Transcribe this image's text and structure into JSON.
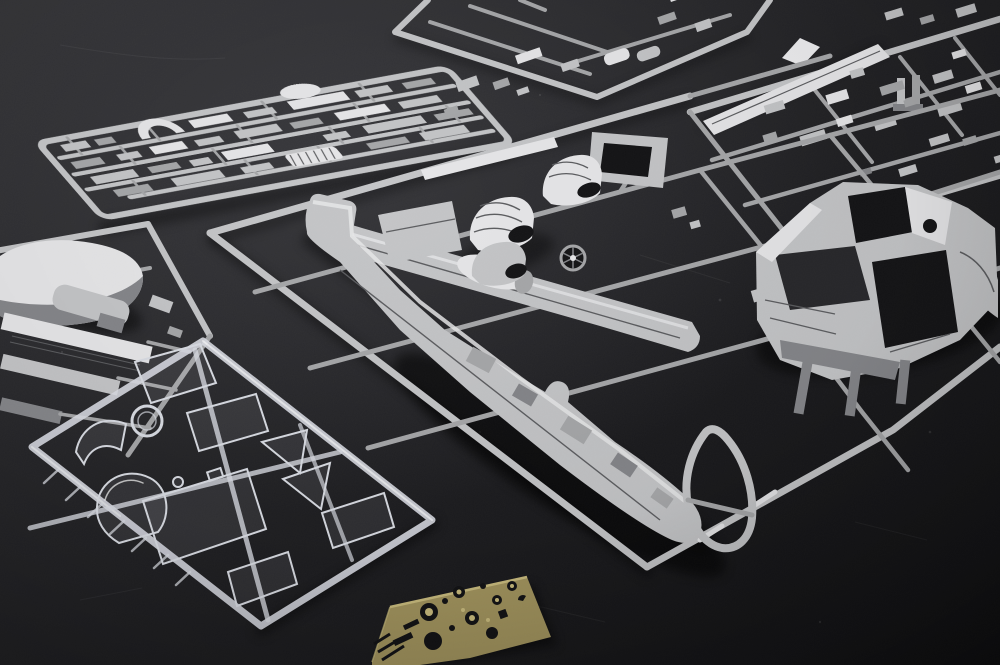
{
  "image": {
    "type": "photograph",
    "subject": "plastic scale-model aircraft kit contents laid out on a dark matte surface",
    "width_px": 1000,
    "height_px": 665
  },
  "colors": {
    "bg_top": "#323235",
    "bg_mid": "#202023",
    "bg_bottom": "#101012",
    "bg_patch": "#3a3a3e",
    "plastic_hi": "#e6e6e8",
    "plastic_light": "#c4c5c7",
    "plastic_mid": "#a6a7a9",
    "plastic_low": "#85868a",
    "plastic_deep": "#5c5d60",
    "opening_dark": "#141416",
    "opening_soft": "#28282b",
    "shadow_color": "#070708",
    "clear_stroke": "#d9dce3",
    "clear_hi": "#ffffff",
    "clear_fill": "rgba(205,210,220,0.10)",
    "brass_base": "#a3955e",
    "brass_hi": "#cbbd7e",
    "brass_hole": "#121214"
  },
  "objects": [
    {
      "id": "sprue-top-left",
      "kind": "gray styrene sprue",
      "contents": "rows of small detail parts, arch-shaped part, corrugated part"
    },
    {
      "id": "sprue-top-center",
      "kind": "gray styrene sprue (partially out of frame)",
      "contents": "small blocks and cylinder parts"
    },
    {
      "id": "sprue-top-right",
      "kind": "gray styrene sprue (runs off right edge)",
      "contents": "long stabilizer strip and many small parts"
    },
    {
      "id": "sprue-left-partial",
      "kind": "gray styrene sprue (partially out of frame)",
      "contents": "engine cowl piece, flap strips, cylinder part"
    },
    {
      "id": "sprue-main",
      "kind": "large gray styrene sprue",
      "contents": "wing half with nacelle, tail boom with fin, crew-pod fuselage halves, windshield frame ring, ribbed engine cowls, intake fan"
    },
    {
      "id": "sprue-clear",
      "kind": "clear styrene sprue",
      "contents": "canopy bubble, windshield, porthole ring, flat window panes"
    },
    {
      "id": "photo-etch-fret",
      "kind": "brass photo-etched fret",
      "contents": "rings, discs and slotted detail parts"
    }
  ]
}
